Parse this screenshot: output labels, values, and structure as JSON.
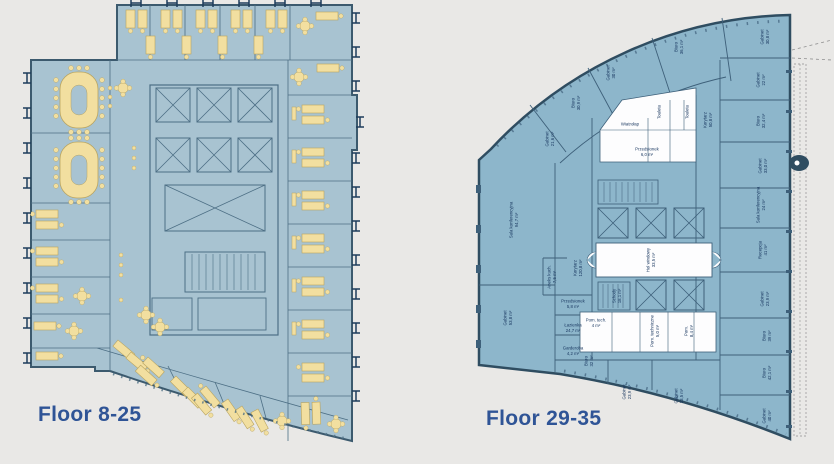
{
  "canvas": {
    "width": 834,
    "height": 464
  },
  "colors": {
    "canvas-bg": "#E9E8E6",
    "caption": "#2F5496",
    "lfill": "#A8C3D1",
    "lwall": "#4D6F85",
    "lowall": "#3C5A6E",
    "furn": "#F2DFA0",
    "fstroke": "#B9A45F",
    "navy": "#1E3C5C",
    "rfill": "#8DB6CB",
    "rwall": "#3E607A",
    "rowall": "#2F4D61",
    "white": "#FDFDFE",
    "label": "#17355E"
  },
  "floorplans": {
    "left": {
      "caption": "Floor 8-25"
    },
    "right": {
      "caption": "Floor 29-35",
      "rooms": [
        {
          "name": "Gabinet",
          "area": "21,6 m²"
        },
        {
          "name": "Biuro",
          "area": "30,9 m²"
        },
        {
          "name": "Gabinet",
          "area": "30 m²"
        },
        {
          "name": "Biuro",
          "area": "36,1 m²"
        },
        {
          "name": "Gabinet",
          "area": "30,8 m²"
        },
        {
          "name": "Gabinet",
          "area": "22 m²"
        },
        {
          "name": "Biuro",
          "area": "32,4 m²"
        },
        {
          "name": "Gabinet",
          "area": "33,0 m²"
        },
        {
          "name": "Sala konferencyjna",
          "area": "24 m²"
        },
        {
          "name": "Recepcja",
          "area": "41 m²"
        },
        {
          "name": "Gabinet",
          "area": "23,9 m²"
        },
        {
          "name": "Biuro",
          "area": "39 m²"
        },
        {
          "name": "Biuro",
          "area": "42,1 m²"
        },
        {
          "name": "Gabinet",
          "area": "40 m²"
        },
        {
          "name": "Sala konferencyjna",
          "area": "94,7 m²"
        },
        {
          "name": "Gabinet",
          "area": "53,8 m²"
        },
        {
          "name": "Korytarz",
          "area": "120,8 m²"
        },
        {
          "name": "Aneks kuch.",
          "area": "7,5 m²"
        },
        {
          "name": "Korytarz",
          "area": "50,8 m²"
        },
        {
          "name": "Hol windowy",
          "area": "33,5 m²"
        },
        {
          "name": "Schody",
          "area": "18,1 m²"
        },
        {
          "name": "Przedsionek",
          "area": "6,0 m²"
        },
        {
          "name": "Wiatrołap",
          "area": ""
        },
        {
          "name": "Toaleta",
          "area": ""
        },
        {
          "name": "Toaleta",
          "area": ""
        },
        {
          "name": "Pom. tech.",
          "area": "4 m²"
        },
        {
          "name": "Pom. techniczne",
          "area": "5,0 m²"
        },
        {
          "name": "Pom.",
          "area": "8,4 m²"
        },
        {
          "name": "Biuro",
          "area": "32 m²"
        },
        {
          "name": "Gabinet",
          "area": "23,9 m²"
        },
        {
          "name": "Gabinet",
          "area": "33,5 m²"
        },
        {
          "name": "Przedsionek",
          "area": "5,8 m²"
        },
        {
          "name": "Łazienka",
          "area": "24,7 m²"
        },
        {
          "name": "Garderoba",
          "area": "4,2 m²"
        }
      ]
    }
  }
}
